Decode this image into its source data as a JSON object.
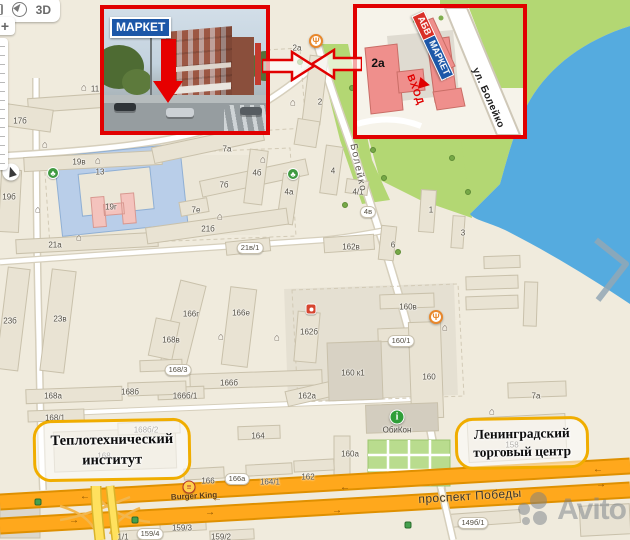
{
  "watermark": "Avito",
  "controls": {
    "mode_3d": "3D",
    "zoom_in": "+"
  },
  "insets": {
    "photo": {
      "sign": {
        "part1": "АБВ",
        "part2": "МАРКЕТ"
      }
    },
    "detail": {
      "building": "2а",
      "sign": {
        "part1": "АБВ",
        "part2": "МАРКЕТ"
      },
      "entrance": "ВХОД",
      "street": "ул. Болейко"
    }
  },
  "callouts": {
    "institute": {
      "line1": "Теплотехнический",
      "line2": "институт"
    },
    "trade_center": {
      "line1": "Ленинградский",
      "line2": "торговый центр"
    }
  },
  "streets": {
    "boleyko": "Болейко",
    "pobedy": "проспект Победы",
    "burger_king": "Burger King",
    "obikon": "ОбиКон"
  },
  "colors": {
    "accent_red": "#e10000",
    "callout_border": "#f0ad00",
    "water": "#55abdf",
    "park": "#b3d773",
    "highway": "#ffa81c",
    "sign_red": "#d92f27",
    "sign_blue": "#1c57a8"
  },
  "map": {
    "building_labels": [
      {
        "t": "1",
        "x": 155,
        "y": 72
      },
      {
        "t": "11",
        "x": 95,
        "y": 89
      },
      {
        "t": "17б",
        "x": 20,
        "y": 121
      },
      {
        "t": "13",
        "x": 100,
        "y": 172
      },
      {
        "t": "19в",
        "x": 79,
        "y": 162
      },
      {
        "t": "19б",
        "x": 9,
        "y": 197
      },
      {
        "t": "19г",
        "x": 111,
        "y": 207
      },
      {
        "t": "21а",
        "x": 55,
        "y": 245
      },
      {
        "t": "23б",
        "x": 10,
        "y": 321
      },
      {
        "t": "23в",
        "x": 60,
        "y": 319
      },
      {
        "t": "7а",
        "x": 227,
        "y": 149
      },
      {
        "t": "7б",
        "x": 224,
        "y": 185
      },
      {
        "t": "7е",
        "x": 196,
        "y": 210
      },
      {
        "t": "4б",
        "x": 257,
        "y": 173
      },
      {
        "t": "4а",
        "x": 289,
        "y": 192
      },
      {
        "t": "21б",
        "x": 208,
        "y": 229
      },
      {
        "t": "21в/1",
        "x": 250,
        "y": 248,
        "pill": true
      },
      {
        "t": "2а",
        "x": 297,
        "y": 48
      },
      {
        "t": "2",
        "x": 320,
        "y": 102
      },
      {
        "t": "4",
        "x": 333,
        "y": 171
      },
      {
        "t": "4/1",
        "x": 358,
        "y": 192
      },
      {
        "t": "4в",
        "x": 368,
        "y": 212,
        "pill": true
      },
      {
        "t": "1",
        "x": 431,
        "y": 210
      },
      {
        "t": "6",
        "x": 393,
        "y": 245
      },
      {
        "t": "162в",
        "x": 351,
        "y": 247
      },
      {
        "t": "3",
        "x": 463,
        "y": 233
      },
      {
        "t": "166г",
        "x": 191,
        "y": 314
      },
      {
        "t": "166е",
        "x": 241,
        "y": 313
      },
      {
        "t": "168в",
        "x": 171,
        "y": 340
      },
      {
        "t": "162б",
        "x": 309,
        "y": 332
      },
      {
        "t": "168/3",
        "x": 178,
        "y": 370,
        "pill": true
      },
      {
        "t": "166б",
        "x": 229,
        "y": 383
      },
      {
        "t": "166б/1",
        "x": 185,
        "y": 396
      },
      {
        "t": "162а",
        "x": 307,
        "y": 396
      },
      {
        "t": "168а",
        "x": 53,
        "y": 396
      },
      {
        "t": "168б",
        "x": 130,
        "y": 392
      },
      {
        "t": "168/1",
        "x": 55,
        "y": 418
      },
      {
        "t": "168б/2",
        "x": 146,
        "y": 430
      },
      {
        "t": "168",
        "x": 104,
        "y": 456
      },
      {
        "t": "164",
        "x": 258,
        "y": 436
      },
      {
        "t": "160а",
        "x": 350,
        "y": 454
      },
      {
        "t": "160в",
        "x": 408,
        "y": 307
      },
      {
        "t": "160/1",
        "x": 401,
        "y": 341,
        "pill": true
      },
      {
        "t": "160 к1",
        "x": 353,
        "y": 373
      },
      {
        "t": "160",
        "x": 429,
        "y": 377
      },
      {
        "t": "158",
        "x": 512,
        "y": 445
      },
      {
        "t": "7а",
        "x": 536,
        "y": 396
      },
      {
        "t": "166",
        "x": 208,
        "y": 481
      },
      {
        "t": "166а",
        "x": 237,
        "y": 479,
        "pill": true
      },
      {
        "t": "164/1",
        "x": 270,
        "y": 482
      },
      {
        "t": "162",
        "x": 308,
        "y": 477
      },
      {
        "t": "1/1",
        "x": 123,
        "y": 537
      },
      {
        "t": "159/4",
        "x": 150,
        "y": 534,
        "pill": true
      },
      {
        "t": "159/3",
        "x": 182,
        "y": 528
      },
      {
        "t": "159/2",
        "x": 221,
        "y": 537
      },
      {
        "t": "149б/1",
        "x": 473,
        "y": 523,
        "pill": true
      }
    ],
    "icon_glyphs": {
      "restaurant-icon": "Ψ",
      "school-icon": "⌂",
      "info-icon": "i",
      "park-icon": "♣",
      "north-arrow-icon": "",
      "burger-king-icon": "≡",
      "red-icon": "",
      "traffic-light-icon": "",
      "tree-icon": ""
    },
    "icons": [
      {
        "type": "restaurant-icon",
        "x": 316,
        "y": 41
      },
      {
        "type": "restaurant-icon",
        "x": 436,
        "y": 317
      },
      {
        "type": "school-icon",
        "x": 84,
        "y": 88
      },
      {
        "type": "school-icon",
        "x": 45,
        "y": 145
      },
      {
        "type": "school-icon",
        "x": 98,
        "y": 161
      },
      {
        "type": "school-icon",
        "x": 38,
        "y": 210
      },
      {
        "type": "school-icon",
        "x": 79,
        "y": 238
      },
      {
        "type": "school-icon",
        "x": 220,
        "y": 217
      },
      {
        "type": "school-icon",
        "x": 263,
        "y": 160
      },
      {
        "type": "school-icon",
        "x": 293,
        "y": 103
      },
      {
        "type": "school-icon",
        "x": 221,
        "y": 337
      },
      {
        "type": "school-icon",
        "x": 277,
        "y": 338
      },
      {
        "type": "school-icon",
        "x": 445,
        "y": 328
      },
      {
        "type": "school-icon",
        "x": 492,
        "y": 412
      },
      {
        "type": "park-icon",
        "x": 293,
        "y": 174
      },
      {
        "type": "park-icon",
        "x": 53,
        "y": 173
      },
      {
        "type": "red-icon",
        "x": 311,
        "y": 309
      },
      {
        "type": "info-icon",
        "x": 397,
        "y": 417
      },
      {
        "type": "north-arrow-icon",
        "x": 11,
        "y": 172
      },
      {
        "type": "burger-king-icon",
        "x": 189,
        "y": 487
      },
      {
        "type": "traffic-light-icon",
        "x": 38,
        "y": 502
      },
      {
        "type": "traffic-light-icon",
        "x": 135,
        "y": 520
      },
      {
        "type": "traffic-light-icon",
        "x": 408,
        "y": 525
      },
      {
        "type": "tree-icon",
        "x": 352,
        "y": 88
      },
      {
        "type": "tree-icon",
        "x": 362,
        "y": 118
      },
      {
        "type": "tree-icon",
        "x": 373,
        "y": 150
      },
      {
        "type": "tree-icon",
        "x": 384,
        "y": 178
      },
      {
        "type": "tree-icon",
        "x": 300,
        "y": 62
      },
      {
        "type": "tree-icon",
        "x": 345,
        "y": 205
      },
      {
        "type": "tree-icon",
        "x": 398,
        "y": 252
      },
      {
        "type": "tree-icon",
        "x": 452,
        "y": 158
      },
      {
        "type": "tree-icon",
        "x": 468,
        "y": 192
      }
    ],
    "lane_arrows": [
      {
        "x": 85,
        "y": 497,
        "ch": "←"
      },
      {
        "x": 217,
        "y": 499,
        "ch": "←"
      },
      {
        "x": 345,
        "y": 488,
        "ch": "←"
      },
      {
        "x": 598,
        "y": 470,
        "ch": "←"
      },
      {
        "x": 74,
        "y": 521,
        "ch": "→"
      },
      {
        "x": 210,
        "y": 513,
        "ch": "→"
      },
      {
        "x": 337,
        "y": 511,
        "ch": "→"
      },
      {
        "x": 601,
        "y": 485,
        "ch": "→"
      }
    ]
  }
}
